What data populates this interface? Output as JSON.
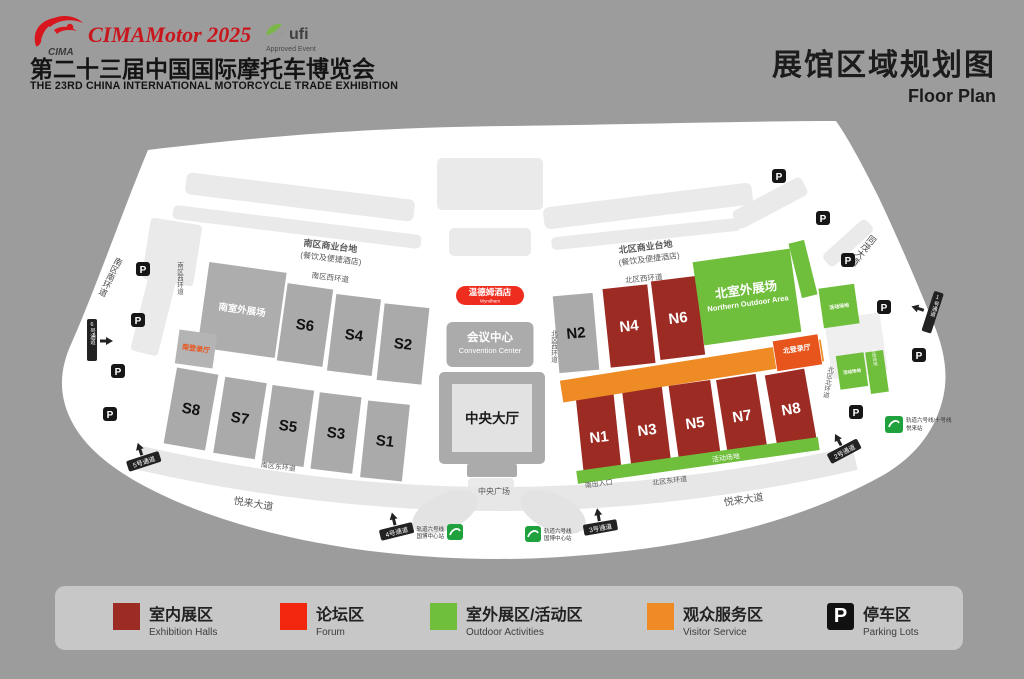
{
  "page": {
    "background": "#9C9C9C"
  },
  "header": {
    "logo_text": "CIMA",
    "event_title": "CIMAMotor 2025",
    "ufi_text": "ufi",
    "ufi_sub": "Approved Event",
    "title_cn": "第二十三届中国国际摩托车博览会",
    "title_en": "THE 23RD CHINA INTERNATIONAL MOTORCYCLE TRADE EXHIBITION",
    "plan_title_cn": "展馆区域规划图",
    "plan_title_en": "Floor Plan"
  },
  "map": {
    "halls": {
      "s1": "S1",
      "s2": "S2",
      "s3": "S3",
      "s4": "S4",
      "s5": "S5",
      "s6": "S6",
      "s7": "S7",
      "s8": "S8",
      "n1": "N1",
      "n2": "N2",
      "n3": "N3",
      "n4": "N4",
      "n5": "N5",
      "n6": "N6",
      "n7": "N7",
      "n8": "N8"
    },
    "areas": {
      "south_outdoor": "南室外展场",
      "north_outdoor_cn": "北室外展场",
      "north_outdoor_en": "Northern Outdoor Area",
      "activity_area": "活动场地"
    },
    "center": {
      "hotel_cn": "温德姆酒店",
      "hotel_en": "Wyndham",
      "convention_cn": "会议中心",
      "convention_en": "Convention Center",
      "central_hall": "中央大厅",
      "central_plaza": "中央广场"
    },
    "registration": {
      "south": "南登录厅",
      "north": "北登录厅"
    },
    "roads": {
      "south_terrace": "南区商业台地",
      "south_terrace_sub": "(餐饮及便捷酒店)",
      "north_terrace": "北区商业台地",
      "north_terrace_sub": "(餐饮及便捷酒店)",
      "south_west": "南区西环道",
      "south_south": "南区南环道",
      "south_east": "南区东环道",
      "north_west": "北区西环道",
      "north_north": "北区北环道",
      "north_east": "北区东环道",
      "tongmao": "同茂大道",
      "yuelai": "悦来大道"
    },
    "entrance_south": "南出入口",
    "gates": {
      "g1": "1号通道",
      "g2": "2号通道",
      "g3": "3号通道",
      "g4": "4号通道",
      "g5": "5号通道",
      "g6": "6号通道"
    },
    "metro": {
      "line6": "轨道六号线",
      "guobo": "国博中心站",
      "line610": "轨道六号线/十号线",
      "yuelai_st": "悦来站"
    },
    "parking_label": "P",
    "colors": {
      "hall_red": "#9C2B24",
      "hall_gray": "#AAAAAA",
      "green": "#6FBE3C",
      "orange": "#EF8B25",
      "hotel_red": "#EE2D1E",
      "white": "#FFFFFF"
    }
  },
  "legend": {
    "items": [
      {
        "cn": "室内展区",
        "en": "Exhibition Halls",
        "color": "#9C2B24"
      },
      {
        "cn": "论坛区",
        "en": "Forum",
        "color": "#F3270F"
      },
      {
        "cn": "室外展区/活动区",
        "en": "Outdoor Activities",
        "color": "#6FBE3C"
      },
      {
        "cn": "观众服务区",
        "en": "Visitor Service",
        "color": "#EF8B25"
      },
      {
        "cn": "停车区",
        "en": "Parking Lots",
        "color": "#111111",
        "symbol": "P"
      }
    ]
  }
}
